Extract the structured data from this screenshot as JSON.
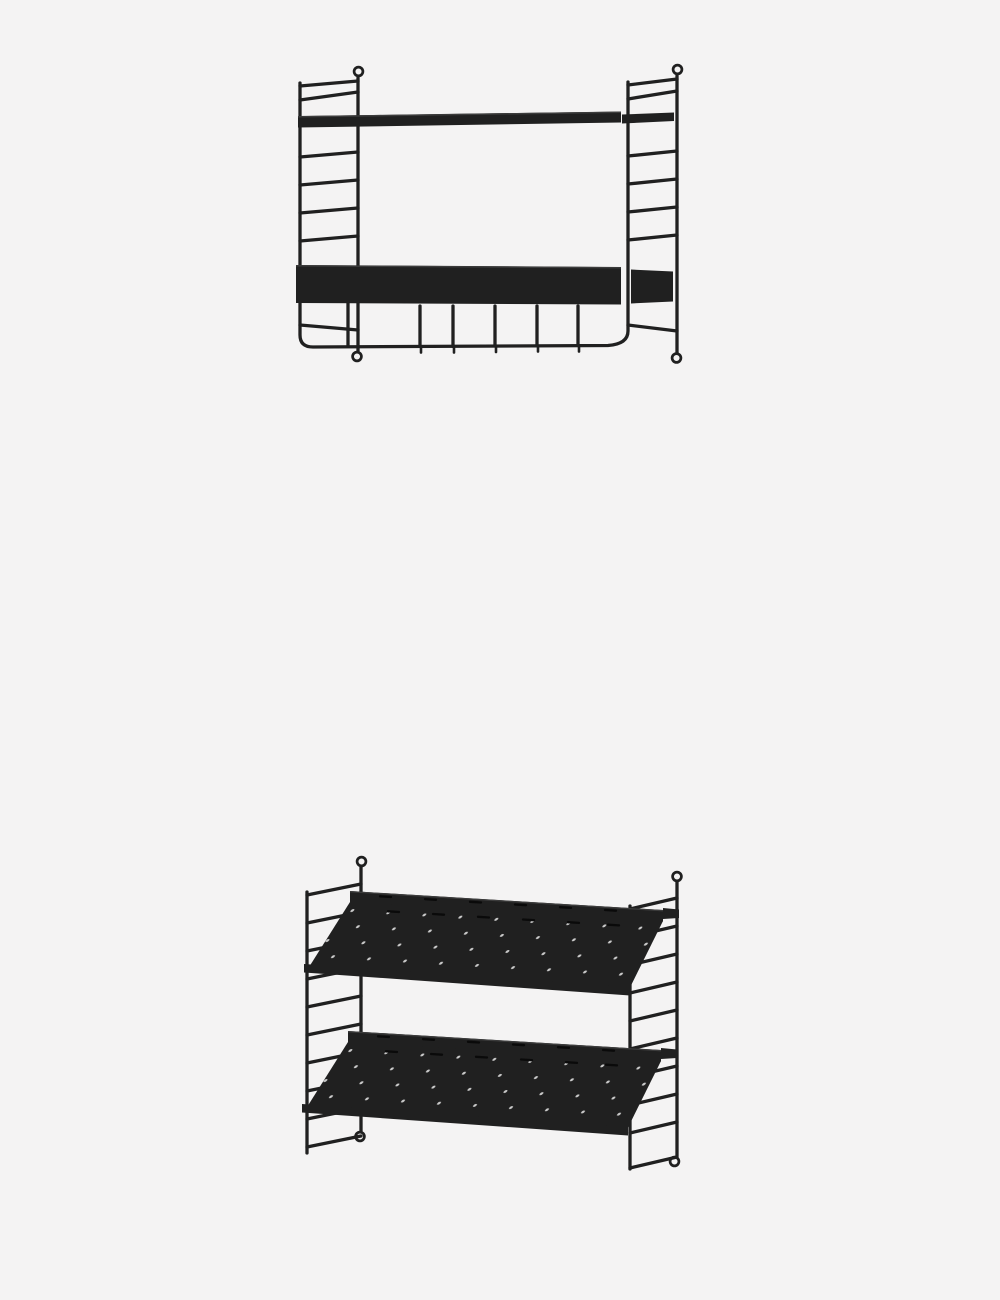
{
  "page": {
    "width_px": 1000,
    "height_px": 1300,
    "background": "#f4f3f3"
  },
  "colors": {
    "background": "#f4f3f3",
    "product": "#202020",
    "edge_highlight": "#3c3c3c",
    "perforation_dot": "#c9c9c9",
    "slot_hole": "#0a0a0a"
  },
  "gallery": {
    "images": [
      {
        "name": "black wall shelf with high-edge shelf and hook rail"
      },
      {
        "name": "black wall shoe shelf with two slanted perforated shelves"
      }
    ]
  }
}
